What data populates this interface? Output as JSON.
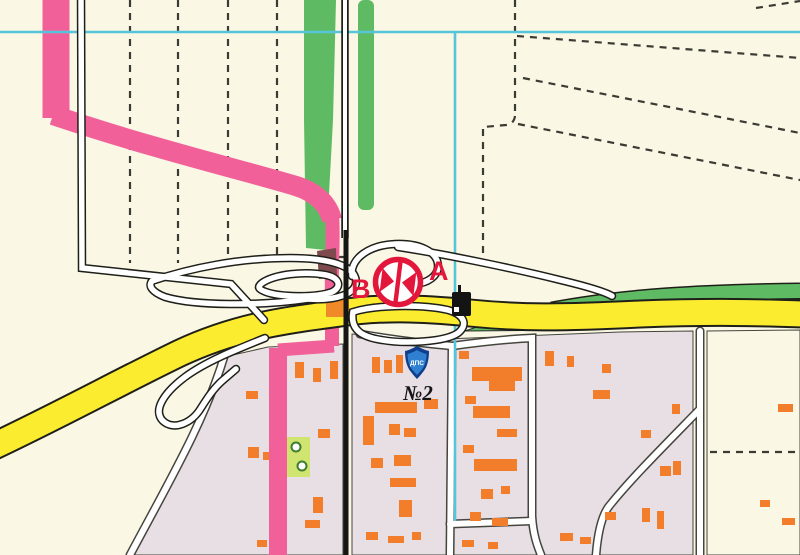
{
  "map": {
    "type": "city-topographic-map",
    "labels": {
      "route_point_b": "B",
      "route_point_a": "A",
      "police_post_shield": "ДПС",
      "block_number": "№2"
    },
    "symbols": [
      {
        "name": "road-closure-marker-icon",
        "meaning": "route closure point between B and A"
      },
      {
        "name": "police-post-shield-icon",
        "meaning": "traffic police post"
      },
      {
        "name": "tree-icon",
        "meaning": "trees in green area"
      },
      {
        "name": "building-icon",
        "meaning": "black building / fuel station"
      }
    ],
    "colors": {
      "bg": "#FAF7E4",
      "lavender": "#E8DFE4",
      "green": "#5FBB63",
      "dash": "#3B3B33",
      "outline": "#45453E",
      "yellow": "#FBEC2F",
      "casing": "#1F1F1A",
      "pink": "#F2609A",
      "cyan": "#56C5DB",
      "orange": "#F27E2C",
      "red": "#E3173C",
      "crossing_orange": "#F08A28",
      "maroon_overlap": "#7E4A4E",
      "lime": "#CFE56F",
      "tree_green": "#3E7D32",
      "shield_dark": "#0F3E8C",
      "shield_light": "#2F80D0",
      "road_black": "#161614"
    }
  }
}
